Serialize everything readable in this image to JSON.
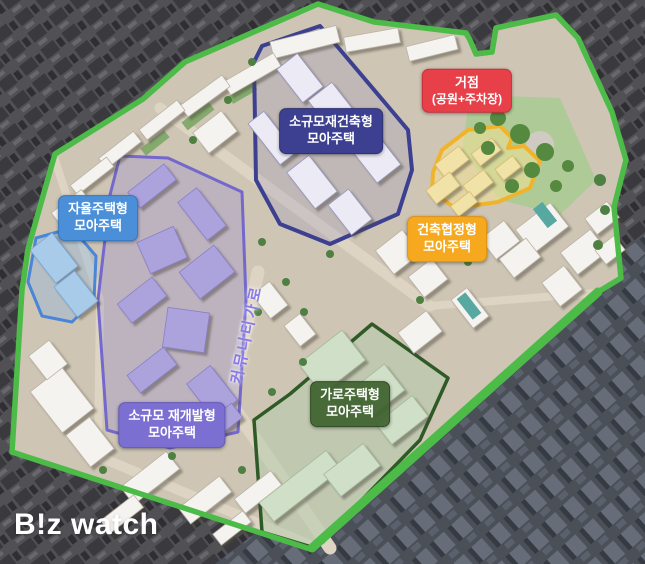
{
  "zones": [
    {
      "id": "small-scale-reconstruction",
      "label_line1": "소규모재건축형",
      "label_line2": "모아주택",
      "color": "#3d4090"
    },
    {
      "id": "hub-park-parking",
      "label_line1": "거점",
      "label_line2": "(공원+주차장)",
      "color": "#e84049"
    },
    {
      "id": "building-agreement",
      "label_line1": "건축협정형",
      "label_line2": "모아주택",
      "color": "#f6a91f"
    },
    {
      "id": "autonomous-housing",
      "label_line1": "자율주택형",
      "label_line2": "모아주택",
      "color": "#4a8fd8"
    },
    {
      "id": "small-scale-redevelopment",
      "label_line1": "소규모 재개발형",
      "label_line2": "모아주택",
      "color": "#7b70d2"
    },
    {
      "id": "street-housing",
      "label_line1": "가로주택형",
      "label_line2": "모아주택",
      "color": "#3e622e"
    }
  ],
  "road_label": "커뮤니티가로",
  "watermark": "B!z watch",
  "colors": {
    "site_boundary": "#4cbb48",
    "road_label_text": "#8a7ae6",
    "outside_buildings": "#3a3a3e",
    "site_ground": "#cec5b4"
  }
}
